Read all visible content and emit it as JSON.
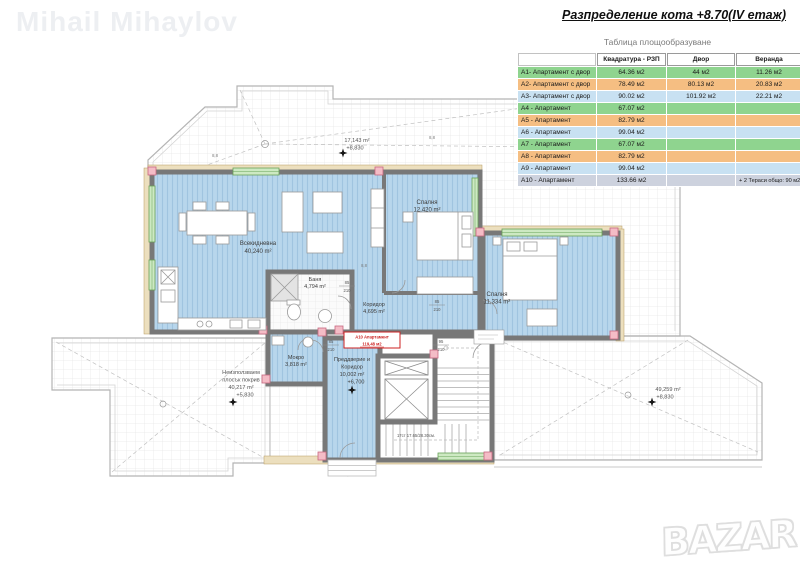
{
  "watermark": "Mihail Mihaylov",
  "logo": "BAZAR",
  "header": {
    "title": "Разпределение кота +8.70(IV етаж)",
    "table_caption": "Таблица площообразуване"
  },
  "table": {
    "columns": [
      "",
      "Квадратура - РЗП",
      "Двор",
      "Веранда"
    ],
    "row_colors": {
      "green": "#8fd48f",
      "orange": "#f5be82",
      "blue": "#c8e1f2",
      "gray": "#cdd2de"
    },
    "rows": [
      {
        "label": "A1- Апартамент с двор",
        "rzp": "64.36 м2",
        "dvor": "44 м2",
        "veranda": "11.26 м2",
        "color": "green"
      },
      {
        "label": "A2- Апартамент с двор",
        "rzp": "78.49 м2",
        "dvor": "80.13 м2",
        "veranda": "20.83 м2",
        "color": "orange"
      },
      {
        "label": "A3- Апартамент с двор",
        "rzp": "90.02 м2",
        "dvor": "101.92 м2",
        "veranda": "22.21 м2",
        "color": "blue"
      },
      {
        "label": "A4 - Апартамент",
        "rzp": "67.07 м2",
        "dvor": "",
        "veranda": "",
        "color": "green"
      },
      {
        "label": "A5 - Апартамент",
        "rzp": "82.79 м2",
        "dvor": "",
        "veranda": "",
        "color": "orange"
      },
      {
        "label": "A6 - Апартамент",
        "rzp": "99.04 м2",
        "dvor": "",
        "veranda": "",
        "color": "blue"
      },
      {
        "label": "A7 - Апартамент",
        "rzp": "67.07 м2",
        "dvor": "",
        "veranda": "",
        "color": "green"
      },
      {
        "label": "A8 - Апартамент",
        "rzp": "82.79 м2",
        "dvor": "",
        "veranda": "",
        "color": "orange"
      },
      {
        "label": "A9 - Апартамент",
        "rzp": "99.04 м2",
        "dvor": "",
        "veranda": "",
        "color": "blue"
      },
      {
        "label": "A10 - Апартамент",
        "rzp": "133.66 м2",
        "dvor": "",
        "veranda": "+ 2 Тераси общо: 90 м2",
        "color": "gray"
      }
    ]
  },
  "plan": {
    "rooms": {
      "living": {
        "name": "Всекидневна",
        "area": "40,240 m²"
      },
      "bedroom1": {
        "name": "Спалня",
        "area": "12,420 m²"
      },
      "bedroom2": {
        "name": "Спалня",
        "area": "11,334 m²"
      },
      "bath": {
        "name": "Баня",
        "area": "4,794 m²"
      },
      "corridor": {
        "name": "Коридор",
        "area": "4,695 m²"
      },
      "mokro": {
        "name": "Мокро",
        "area": "3,818 m²"
      },
      "hall": {
        "name1": "Преддверие и",
        "name2": "Коридор",
        "area": "10,002 m²",
        "level": "+6,700"
      }
    },
    "terraces": {
      "left": {
        "l1": "Неизползваем",
        "l2": "плосък покрив",
        "area": "40,217 m²",
        "level": "+5,830"
      },
      "right": {
        "area": "49,259 m²",
        "level": "+8,830"
      },
      "top": {
        "area": "17,143 m²",
        "level": "+8,830"
      }
    },
    "stamp_a10": {
      "l1": "А10 Апартамент",
      "l2": "119,48 м2"
    },
    "stairs_note": "17ст 17.65/28.30см.",
    "door_dims": [
      {
        "w": "85",
        "h": "210"
      },
      {
        "w": "85",
        "h": "210"
      },
      {
        "w": "85",
        "h": "210"
      },
      {
        "w": "95",
        "h": "210"
      }
    ],
    "section_marks": [
      "8,8",
      "8,8",
      "8,8",
      "8,3"
    ],
    "colors": {
      "floor_blue": "#b8d6ec",
      "hatch": "#a0c4e0",
      "wall": "#787878",
      "window_green": "#cde9c2",
      "insulation": "#ecdfbe",
      "column_pink": "#f4bcc6",
      "stamp_red": "#cc2222"
    }
  }
}
